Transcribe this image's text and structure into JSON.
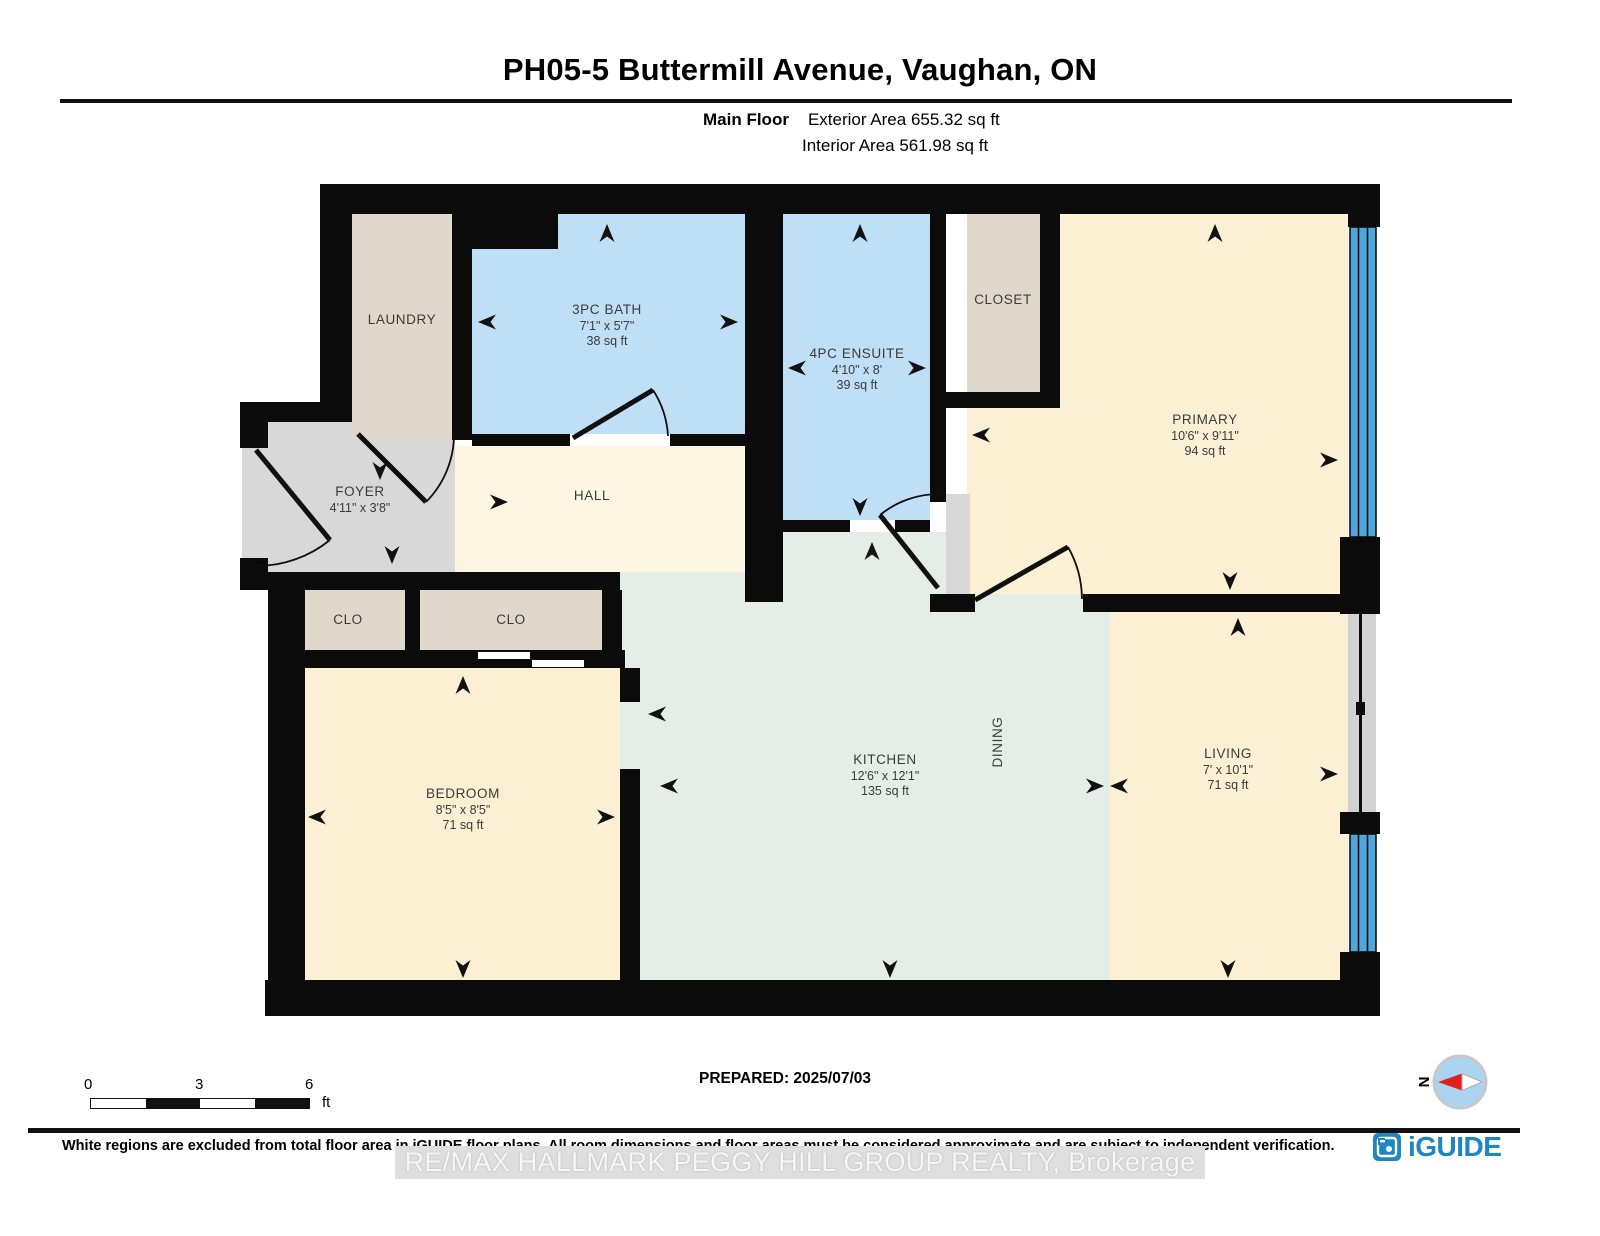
{
  "header": {
    "title": "PH05-5 Buttermill Avenue, Vaughan, ON",
    "floor_label": "Main Floor",
    "exterior_area": "Exterior Area 655.32 sq ft",
    "interior_area": "Interior Area 561.98 sq ft"
  },
  "rooms": {
    "laundry": {
      "name": "LAUNDRY"
    },
    "bath": {
      "name": "3PC BATH",
      "dims": "7'1\" x 5'7\"",
      "area": "38 sq ft"
    },
    "ensuite": {
      "name": "4PC ENSUITE",
      "dims": "4'10\" x 8'",
      "area": "39 sq ft"
    },
    "closet": {
      "name": "CLOSET"
    },
    "primary": {
      "name": "PRIMARY",
      "dims": "10'6\" x 9'11\"",
      "area": "94 sq ft"
    },
    "foyer": {
      "name": "FOYER",
      "dims": "4'11\" x 3'8\""
    },
    "hall": {
      "name": "HALL"
    },
    "clo_left": {
      "name": "CLO"
    },
    "clo_right": {
      "name": "CLO"
    },
    "bedroom": {
      "name": "BEDROOM",
      "dims": "8'5\" x 8'5\"",
      "area": "71 sq ft"
    },
    "kitchen": {
      "name": "KITCHEN",
      "dims": "12'6\" x 12'1\"",
      "area": "135 sq ft"
    },
    "dining": {
      "name": "DINING"
    },
    "living": {
      "name": "LIVING",
      "dims": "7' x 10'1\"",
      "area": "71 sq ft"
    }
  },
  "scale_bar": {
    "ticks": [
      "0",
      "3",
      "6"
    ],
    "unit": "ft"
  },
  "prepared": "PREPARED: 2025/07/03",
  "compass": {
    "label": "N"
  },
  "footer": {
    "disclaimer": "White regions are excluded from total floor area in iGUIDE floor plans. All room dimensions and floor areas must be considered approximate and are subject to independent verification.",
    "watermark": "RE/MAX HALLMARK PEGGY HILL GROUP REALTY, Brokerage",
    "logo_text": "iGUIDE"
  },
  "colors": {
    "wall": "#0b0b0b",
    "room_cream": "#fbf0d3",
    "room_cream_light": "#fdf6e3",
    "room_blue": "#bedff6",
    "room_tan": "#e0d8ca",
    "room_gray": "#d8d8d8",
    "room_mint": "#e4eee7",
    "window_blue": "#4ea6da",
    "balcony_gray": "#d2d2d2",
    "logo_blue": "#1f86c4"
  }
}
